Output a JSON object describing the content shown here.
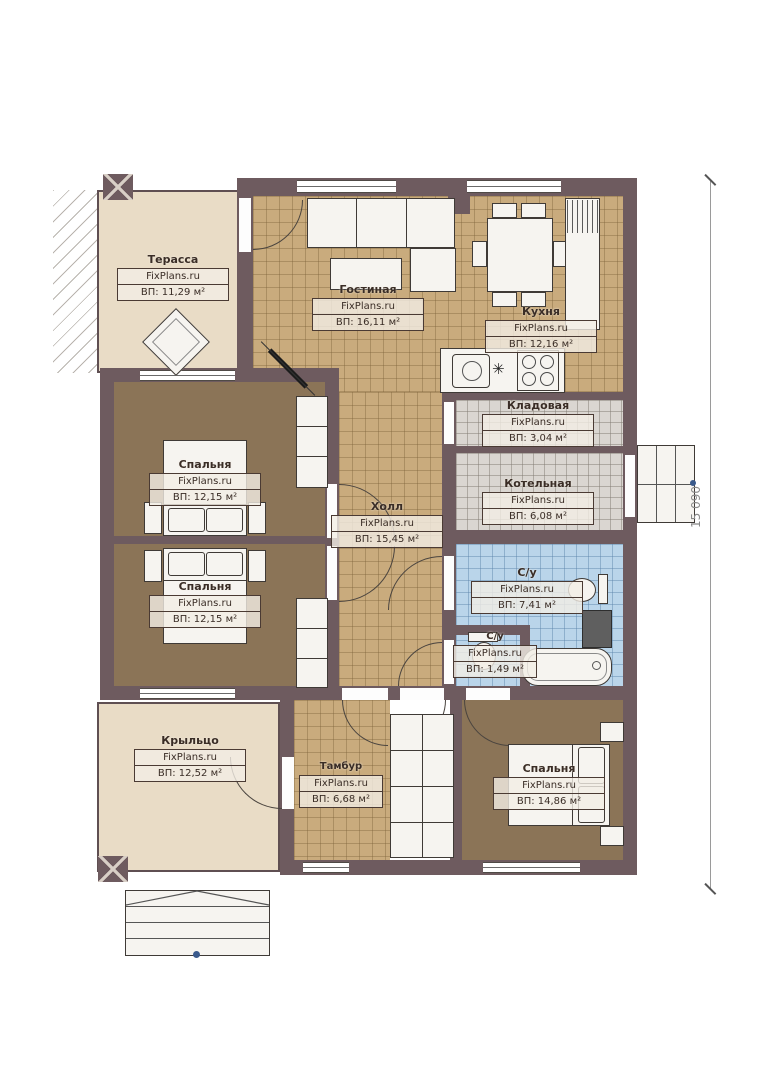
{
  "plan": {
    "dimension_right": "15 090",
    "colors": {
      "wall": "#6e5b5f",
      "tile_tan": "#c9ab7d",
      "tile_blue": "#bad5ea",
      "tile_gray": "#dad6d1",
      "floor_brown": "#8b7457",
      "floor_beige": "#e9dcc6",
      "furniture": "#f6f4f0"
    },
    "rooms": [
      {
        "id": "terrace",
        "name": "Терасса",
        "watermark": "FixPlans.ru",
        "area": "ВП: 11,29 м²"
      },
      {
        "id": "living",
        "name": "Гостиная",
        "watermark": "FixPlans.ru",
        "area": "ВП: 16,11 м²"
      },
      {
        "id": "kitchen",
        "name": "Кухня",
        "watermark": "FixPlans.ru",
        "area": "ВП: 12,16 м²"
      },
      {
        "id": "storage",
        "name": "Кладовая",
        "watermark": "FixPlans.ru",
        "area": "ВП: 3,04 м²"
      },
      {
        "id": "boiler",
        "name": "Котельная",
        "watermark": "FixPlans.ru",
        "area": "ВП: 6,08 м²"
      },
      {
        "id": "bedroom1",
        "name": "Спальня",
        "watermark": "FixPlans.ru",
        "area": "ВП: 12,15 м²"
      },
      {
        "id": "bedroom2",
        "name": "Спальня",
        "watermark": "FixPlans.ru",
        "area": "ВП: 12,15 м²"
      },
      {
        "id": "hall",
        "name": "Холл",
        "watermark": "FixPlans.ru",
        "area": "ВП: 15,45 м²"
      },
      {
        "id": "bathroom",
        "name": "С/у",
        "watermark": "FixPlans.ru",
        "area": "ВП: 7,41 м²"
      },
      {
        "id": "wc",
        "name": "С/у",
        "watermark": "FixPlans.ru",
        "area": "ВП: 1,49 м²"
      },
      {
        "id": "porch",
        "name": "Крыльцо",
        "watermark": "FixPlans.ru",
        "area": "ВП: 12,52 м²"
      },
      {
        "id": "vestibule",
        "name": "Тамбур",
        "watermark": "FixPlans.ru",
        "area": "ВП: 6,68 м²"
      },
      {
        "id": "bedroom3",
        "name": "Спальня",
        "watermark": "FixPlans.ru",
        "area": "ВП: 14,86 м²"
      }
    ]
  }
}
